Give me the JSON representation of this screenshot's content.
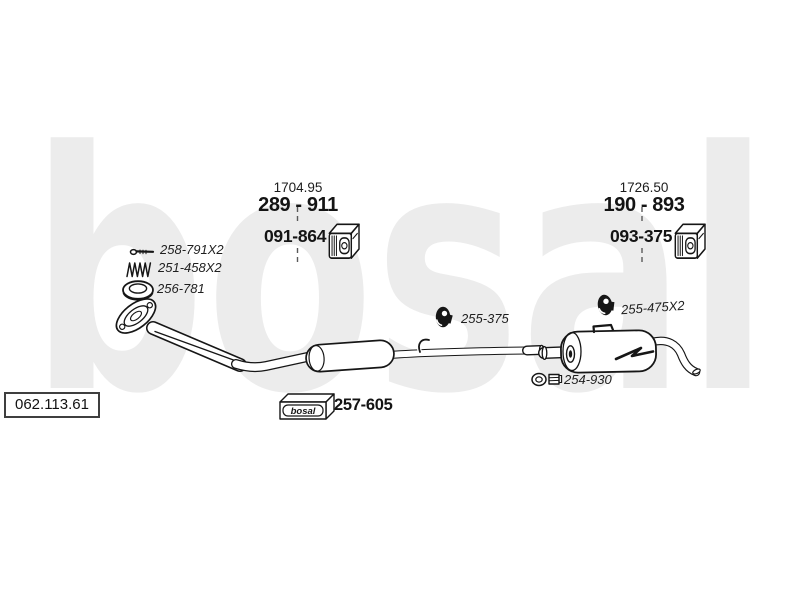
{
  "watermark": "bosal",
  "brand": "bosal",
  "reference_code": "062.113.61",
  "front_assembly": {
    "dimension": "1704.95",
    "pipe_part": "289 - 911",
    "mount_part": "091-864"
  },
  "rear_assembly": {
    "dimension": "1726.50",
    "muffler_part": "190 - 893",
    "mount_part": "093-375"
  },
  "small_parts": {
    "bolt": "258-791X2",
    "spring": "251-458X2",
    "gasket": "256-781",
    "center_clamp": "255-375",
    "rear_clamp": "255-475X2",
    "tail_clamp": "254-930",
    "fitting_kit": "257-605"
  },
  "colors": {
    "ink": "#161616",
    "watermark_gray": "#ececec"
  }
}
